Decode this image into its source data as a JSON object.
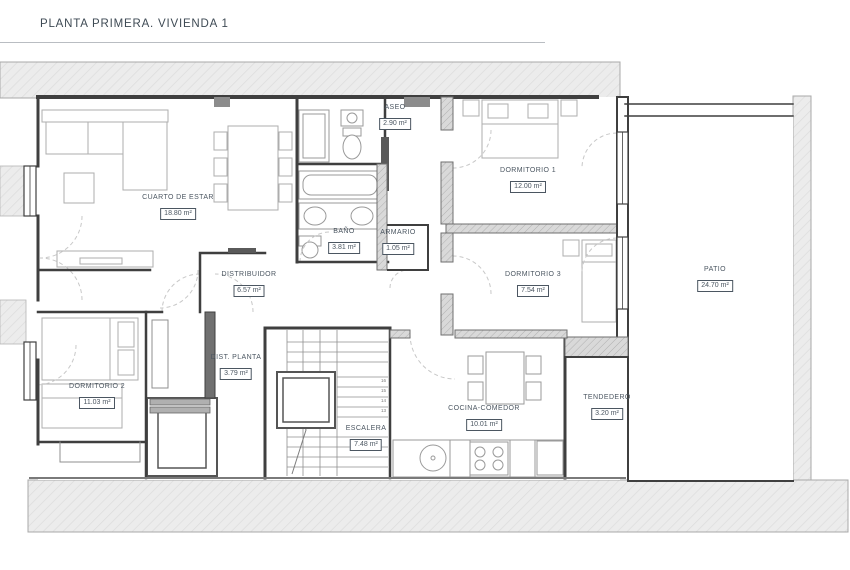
{
  "title": "PLANTA PRIMERA. VIVIENDA 1",
  "colors": {
    "text": "#4b5661",
    "wall": "#3f3f3f",
    "wall_dark_fill": "#707070",
    "furniture_line": "#adadad",
    "fixture_line": "#9a9a9a",
    "door_arc": "#c8c8c8",
    "site_hatch_fill": "#ececec",
    "site_hatch_line": "#dcdcdc",
    "wall_hatch_fill": "#d9d9d9",
    "wall_hatch_line": "#b0b0b0",
    "background": "#ffffff"
  },
  "rooms": [
    {
      "id": "cuarto-de-estar",
      "name": "CUARTO DE ESTAR",
      "area": "18.80 m²"
    },
    {
      "id": "aseo",
      "name": "ASEO",
      "area": "2.90 m²"
    },
    {
      "id": "dormitorio-1",
      "name": "DORMITORIO 1",
      "area": "12.00 m²"
    },
    {
      "id": "bano",
      "name": "BAÑO",
      "area": "3.81 m²"
    },
    {
      "id": "armario",
      "name": "ARMARIO",
      "area": "1.05 m²"
    },
    {
      "id": "distribuidor",
      "name": "DISTRIBUIDOR",
      "area": "6.57 m²"
    },
    {
      "id": "dormitorio-3",
      "name": "DORMITORIO 3",
      "area": "7.54 m²"
    },
    {
      "id": "patio",
      "name": "PATIO",
      "area": "24.70 m²"
    },
    {
      "id": "dormitorio-2",
      "name": "DORMITORIO 2",
      "area": "11.03 m²"
    },
    {
      "id": "dist-planta",
      "name": "DIST. PLANTA",
      "area": "3.79 m²"
    },
    {
      "id": "escalera",
      "name": "ESCALERA",
      "area": "7.48 m²"
    },
    {
      "id": "cocina-comedor",
      "name": "COCINA-COMEDOR",
      "area": "10.01 m²"
    },
    {
      "id": "tendedero",
      "name": "TENDEDERO",
      "area": "3.20 m²"
    }
  ],
  "stairs": {
    "numbers": [
      "16",
      "15",
      "14",
      "13"
    ]
  }
}
